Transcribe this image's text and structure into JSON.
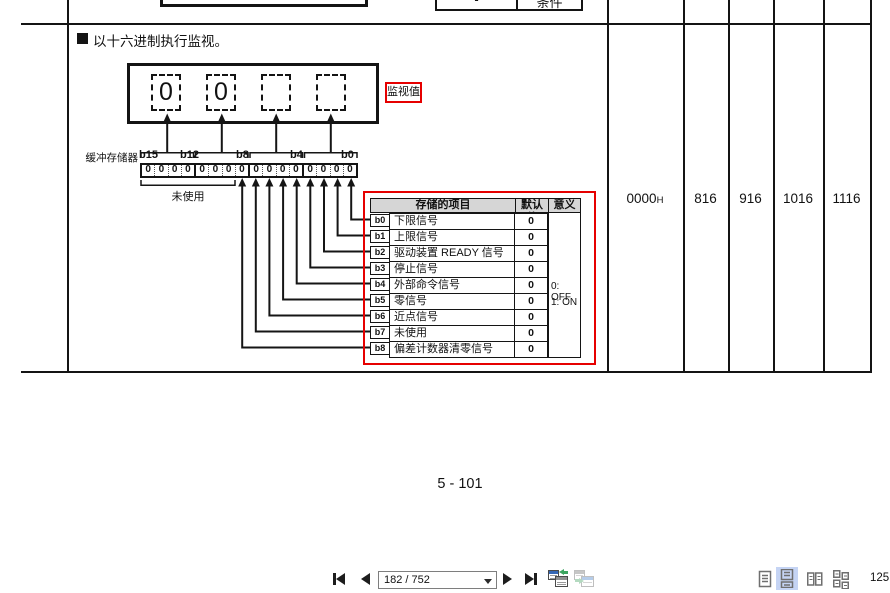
{
  "colors": {
    "accent_red": "#e60000",
    "selected_layout_bg": "#c5d4f4"
  },
  "document": {
    "section_bullet": "■",
    "section_title": "以十六进制执行监视。",
    "page_number": "5 - 101",
    "top_partial": {
      "left_cell": "-",
      "right_cell": "条件"
    }
  },
  "diagram": {
    "monitor_value_label": "监视值",
    "monitor_digits": [
      "0",
      "0",
      "",
      ""
    ],
    "buffer_memory_label": "缓冲存储器",
    "bit_position_labels": [
      "b15",
      "b12",
      "b8",
      "b4",
      "b0"
    ],
    "bit_values": [
      "0",
      "0",
      "0",
      "0",
      "0",
      "0",
      "0",
      "0",
      "0",
      "0",
      "0",
      "0",
      "0",
      "0",
      "0",
      "0"
    ],
    "unused_label": "未使用"
  },
  "signal_table": {
    "header": {
      "item": "存储的项目",
      "default_value": "默认值",
      "meaning": "意义"
    },
    "rows": [
      {
        "bit": "b0",
        "name": "下限信号",
        "default_value": "0"
      },
      {
        "bit": "b1",
        "name": "上限信号",
        "default_value": "0"
      },
      {
        "bit": "b2",
        "name": "驱动装置 READY 信号",
        "default_value": "0"
      },
      {
        "bit": "b3",
        "name": "停止信号",
        "default_value": "0"
      },
      {
        "bit": "b4",
        "name": "外部命令信号",
        "default_value": "0"
      },
      {
        "bit": "b5",
        "name": "零信号",
        "default_value": "0"
      },
      {
        "bit": "b6",
        "name": "近点信号",
        "default_value": "0"
      },
      {
        "bit": "b7",
        "name": "未使用",
        "default_value": "0"
      },
      {
        "bit": "b8",
        "name": "偏差计数器清零信号",
        "default_value": "0"
      }
    ],
    "meaning": {
      "off": "0: OFF",
      "on": "1: ON"
    }
  },
  "memory_columns": {
    "default_value": "0000",
    "default_value_suffix": "H",
    "addresses": [
      "816",
      "916",
      "1016",
      "1116"
    ]
  },
  "viewer_toolbar": {
    "page_indicator": "182 / 752",
    "zoom_percent": "125"
  }
}
